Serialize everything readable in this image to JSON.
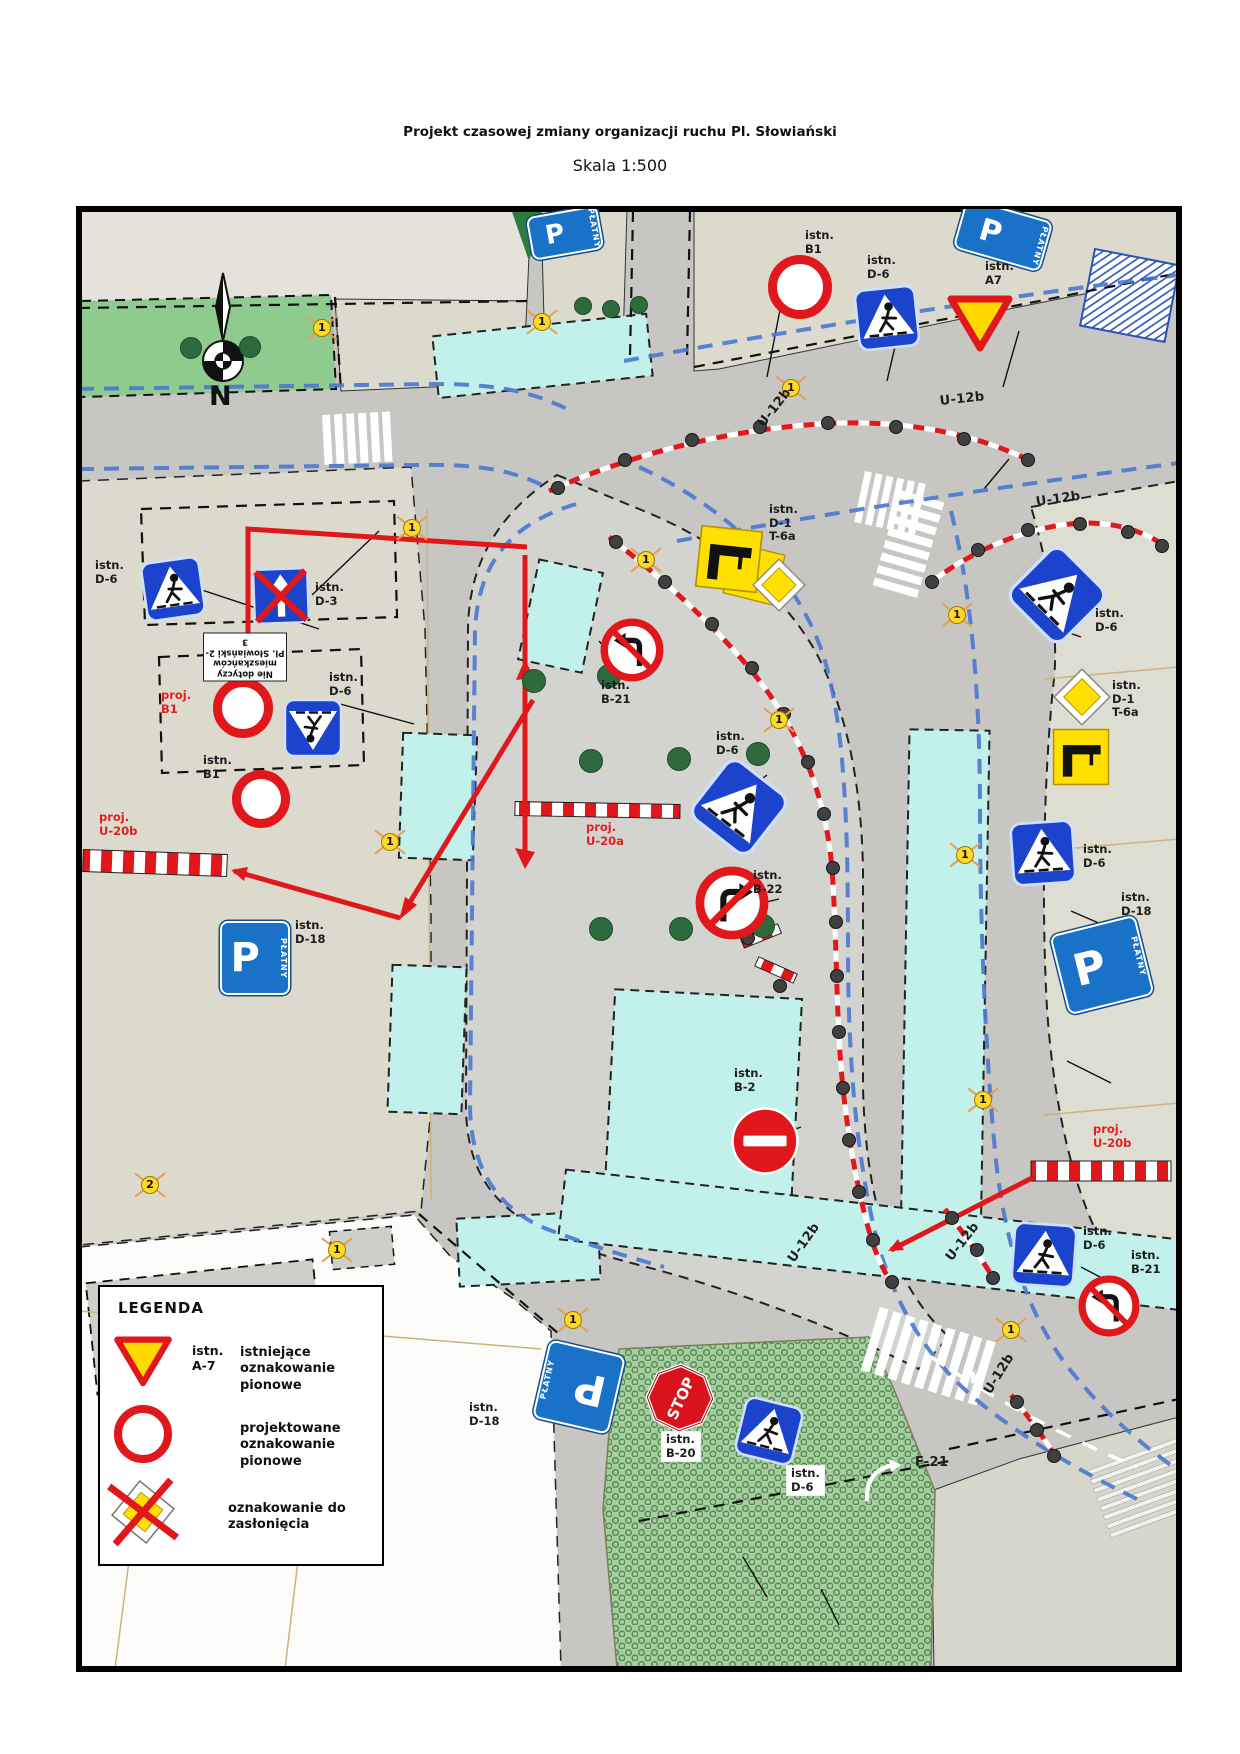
{
  "title": "Projekt czasowej zmiany organizacji ruchu Pl. Słowiański",
  "scale_label": "Skala 1:500",
  "compass": {
    "north": "N"
  },
  "sign_texts": {
    "p": "P",
    "platny": "PŁATNY",
    "stop": "STOP"
  },
  "note_plate": {
    "line1": "Nie dotyczy",
    "line2": "mieszkańców",
    "line3": "Pl. Słowiański 2-3"
  },
  "legend": {
    "title": "LEGENDA",
    "item1_code": "istn.\nA-7",
    "item1_desc": "istniejące oznakowanie pionowe",
    "item2_desc": "projektowane oznakowanie pionowe",
    "item3_desc": "oznakowanie do zasłonięcia"
  },
  "colors": {
    "proj_red": "#e02020",
    "barrier_red": "#e0181b",
    "sign_blue": "#1b43cc",
    "parking_blue": "#1a72c8",
    "cyan_zone": "#c2f1ec",
    "road_gray": "#c7c6c2",
    "block_beige": "#dcdacd",
    "green_area": "#8fca8f",
    "line_blue": "#4a78d0",
    "sign_yellow": "#ffd900"
  },
  "map_labels": [
    {
      "text": "istn.\nB1",
      "x": 726,
      "y": 20
    },
    {
      "text": "istn.\nD-6",
      "x": 788,
      "y": 45
    },
    {
      "text": "istn.\nA7",
      "x": 906,
      "y": 51
    },
    {
      "text": "U-12b",
      "x": 676,
      "y": 212,
      "rot": -52,
      "bold": true
    },
    {
      "text": "U-12b",
      "x": 860,
      "y": 185,
      "rot": -6,
      "bold": true
    },
    {
      "text": "U-12b",
      "x": 956,
      "y": 286,
      "rot": -8,
      "bold": true
    },
    {
      "text": "istn.\nD-1\nT-6a",
      "x": 690,
      "y": 294
    },
    {
      "text": "istn.\nD-3",
      "x": 236,
      "y": 372
    },
    {
      "text": "istn.\nD-6",
      "x": 16,
      "y": 350
    },
    {
      "text": "istn.\nD-6",
      "x": 250,
      "y": 462
    },
    {
      "text": "proj.\nB1",
      "x": 82,
      "y": 480,
      "color": "red"
    },
    {
      "text": "istn.\nB1",
      "x": 124,
      "y": 545
    },
    {
      "text": "proj.\nU-20b",
      "x": 20,
      "y": 602,
      "color": "red"
    },
    {
      "text": "istn.\nD-18",
      "x": 216,
      "y": 710
    },
    {
      "text": "istn.\nB-21",
      "x": 522,
      "y": 470
    },
    {
      "text": "istn.\nD-6",
      "x": 637,
      "y": 521
    },
    {
      "text": "proj.\nU-20a",
      "x": 507,
      "y": 612,
      "color": "red"
    },
    {
      "text": "istn.\nB-22",
      "x": 674,
      "y": 660
    },
    {
      "text": "istn.\nB-2",
      "x": 655,
      "y": 858
    },
    {
      "text": "U-12b",
      "x": 706,
      "y": 1048,
      "rot": -55,
      "bold": true
    },
    {
      "text": "U-12b",
      "x": 864,
      "y": 1046,
      "rot": -52,
      "bold": true
    },
    {
      "text": "U-12b",
      "x": 902,
      "y": 1180,
      "rot": -58,
      "bold": true
    },
    {
      "text": "istn.\nD-6",
      "x": 1016,
      "y": 398
    },
    {
      "text": "istn.\nD-1\nT-6a",
      "x": 1033,
      "y": 470
    },
    {
      "text": "istn.\nD-6",
      "x": 1004,
      "y": 634
    },
    {
      "text": "istn.\nD-18",
      "x": 1042,
      "y": 682
    },
    {
      "text": "proj.\nU-20b",
      "x": 1014,
      "y": 914,
      "color": "red"
    },
    {
      "text": "istn.\nD-6",
      "x": 1004,
      "y": 1016
    },
    {
      "text": "istn.\nB-21",
      "x": 1052,
      "y": 1040
    },
    {
      "text": "istn.\nB-20",
      "x": 582,
      "y": 1222,
      "bg": true
    },
    {
      "text": "istn.\nD-6",
      "x": 707,
      "y": 1256,
      "bg": true
    },
    {
      "text": "istn.\nD-18",
      "x": 390,
      "y": 1192
    },
    {
      "text": "F-21",
      "x": 836,
      "y": 1246,
      "bold": true
    }
  ],
  "markers": [
    {
      "n": "1",
      "x": 243,
      "y": 119
    },
    {
      "n": "1",
      "x": 463,
      "y": 113
    },
    {
      "n": "1",
      "x": 712,
      "y": 179
    },
    {
      "n": "1",
      "x": 333,
      "y": 319
    },
    {
      "n": "1",
      "x": 567,
      "y": 351
    },
    {
      "n": "1",
      "x": 878,
      "y": 406
    },
    {
      "n": "1",
      "x": 700,
      "y": 511
    },
    {
      "n": "1",
      "x": 311,
      "y": 633
    },
    {
      "n": "1",
      "x": 886,
      "y": 646
    },
    {
      "n": "1",
      "x": 904,
      "y": 891
    },
    {
      "n": "2",
      "x": 71,
      "y": 976
    },
    {
      "n": "1",
      "x": 258,
      "y": 1041
    },
    {
      "n": "1",
      "x": 494,
      "y": 1111
    },
    {
      "n": "1",
      "x": 932,
      "y": 1121
    }
  ],
  "trees": [
    {
      "x": 454,
      "y": 471,
      "r": 11
    },
    {
      "x": 529,
      "y": 466,
      "r": 11
    },
    {
      "x": 511,
      "y": 551,
      "r": 11
    },
    {
      "x": 599,
      "y": 549,
      "r": 11
    },
    {
      "x": 678,
      "y": 544,
      "r": 11
    },
    {
      "x": 521,
      "y": 719,
      "r": 11
    },
    {
      "x": 601,
      "y": 719,
      "r": 11
    },
    {
      "x": 683,
      "y": 716,
      "r": 11
    },
    {
      "x": 503,
      "y": 96,
      "r": 8
    },
    {
      "x": 531,
      "y": 99,
      "r": 8
    },
    {
      "x": 559,
      "y": 95,
      "r": 8
    },
    {
      "x": 111,
      "y": 138,
      "r": 10
    },
    {
      "x": 170,
      "y": 137,
      "r": 10
    }
  ],
  "dots": [
    [
      478,
      278
    ],
    [
      545,
      250
    ],
    [
      612,
      230
    ],
    [
      680,
      217
    ],
    [
      748,
      213
    ],
    [
      816,
      217
    ],
    [
      884,
      229
    ],
    [
      948,
      250
    ],
    [
      852,
      372
    ],
    [
      898,
      340
    ],
    [
      948,
      320
    ],
    [
      1000,
      314
    ],
    [
      1048,
      322
    ],
    [
      1082,
      336
    ],
    [
      536,
      332
    ],
    [
      585,
      372
    ],
    [
      632,
      414
    ],
    [
      672,
      458
    ],
    [
      704,
      504
    ],
    [
      728,
      552
    ],
    [
      744,
      604
    ],
    [
      753,
      658
    ],
    [
      756,
      712
    ],
    [
      757,
      766
    ],
    [
      759,
      822
    ],
    [
      763,
      878
    ],
    [
      769,
      930
    ],
    [
      779,
      982
    ],
    [
      793,
      1030
    ],
    [
      812,
      1072
    ],
    [
      872,
      1008
    ],
    [
      897,
      1040
    ],
    [
      913,
      1068
    ],
    [
      937,
      1192
    ],
    [
      957,
      1220
    ],
    [
      974,
      1246
    ],
    [
      668,
      728
    ],
    [
      700,
      776
    ]
  ]
}
